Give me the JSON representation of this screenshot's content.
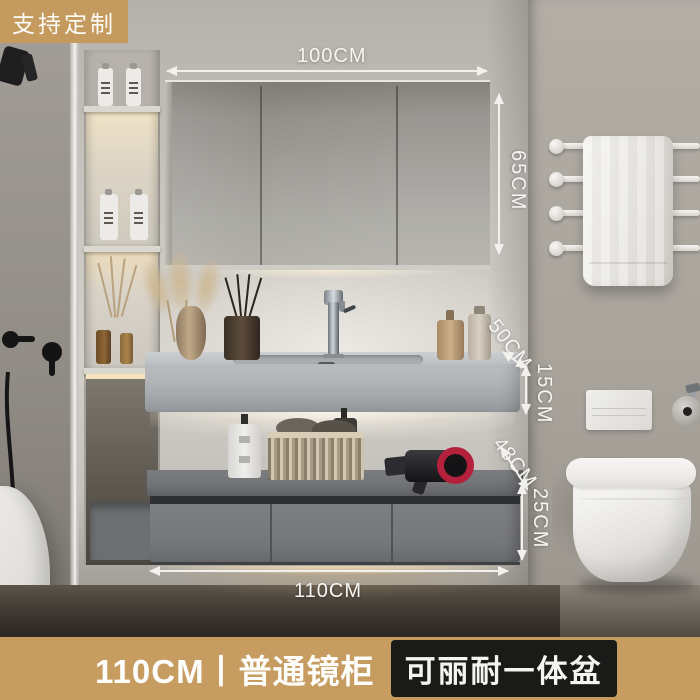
{
  "badges": {
    "customize": "支持定制"
  },
  "dims": {
    "d100": "100CM",
    "d65": "65CM",
    "d50": "50CM",
    "d15": "15CM",
    "d48": "48CM",
    "d25": "25CM",
    "d110": "110CM"
  },
  "banner": {
    "left": "110CM丨普通镜柜",
    "right": "可丽耐一体盆"
  },
  "colors": {
    "accent_gold": "#c69c60",
    "badge_black": "#1a1a19",
    "annotation_white": "#f2f1ee",
    "mirror_gray": "#a09d98",
    "cabinet_gray": "#747679",
    "counter_gray": "#b0b3b6"
  }
}
